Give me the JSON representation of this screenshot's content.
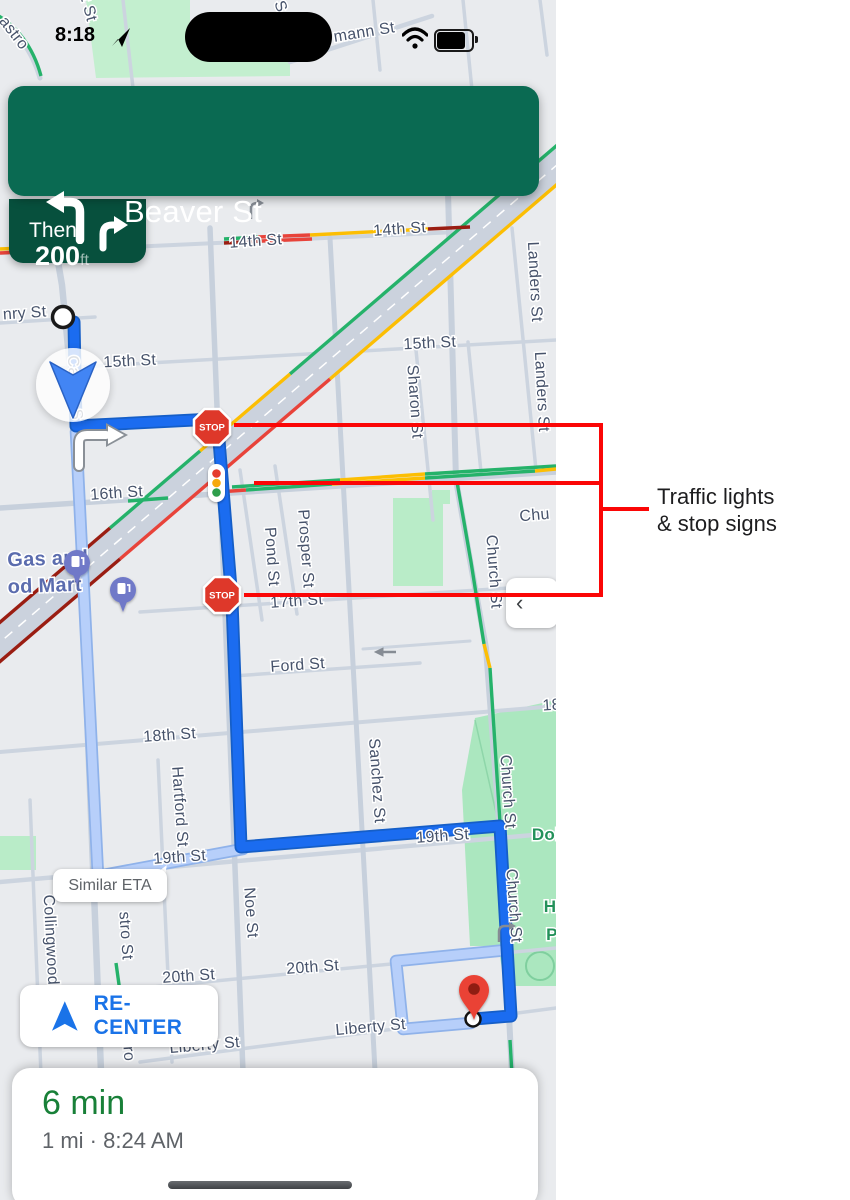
{
  "status_bar": {
    "time": "8:18"
  },
  "navigation_banner": {
    "distance": "200",
    "unit": "ft",
    "instruction": "Beaver St",
    "then_label": "Then"
  },
  "map": {
    "stop_sign_text": "STOP",
    "similar_eta_label": "Similar ETA",
    "recenter_label": "RE-CENTER",
    "side_panel_chevron": "‹",
    "labels": [
      {
        "t": "astro",
        "x": 10,
        "y": 36,
        "r": 52,
        "c": "st"
      },
      {
        "t": "t St",
        "x": 84,
        "y": 10,
        "r": 75,
        "c": "st"
      },
      {
        "t": "S",
        "x": 276,
        "y": 8,
        "r": 70,
        "c": "st"
      },
      {
        "t": "mann St",
        "x": 365,
        "y": 37,
        "r": -9,
        "c": "st"
      },
      {
        "t": "nry St",
        "x": 25,
        "y": 318,
        "r": -4,
        "c": "st"
      },
      {
        "t": "Castro S",
        "x": 70,
        "y": 388,
        "r": 86,
        "c": "st"
      },
      {
        "t": "15th St",
        "x": 130,
        "y": 366,
        "r": -3,
        "c": "st"
      },
      {
        "t": "15th St",
        "x": 430,
        "y": 348,
        "r": -3,
        "c": "st"
      },
      {
        "t": "14th St",
        "x": 256,
        "y": 246,
        "r": -4,
        "c": "st"
      },
      {
        "t": "14th St",
        "x": 400,
        "y": 234,
        "r": -4,
        "c": "st"
      },
      {
        "t": "Sharon St",
        "x": 410,
        "y": 402,
        "r": 86,
        "c": "st"
      },
      {
        "t": "Landers St",
        "x": 530,
        "y": 282,
        "r": 87,
        "c": "st"
      },
      {
        "t": "Landers St",
        "x": 537,
        "y": 392,
        "r": 87,
        "c": "st"
      },
      {
        "t": "16th St",
        "x": 117,
        "y": 498,
        "r": -4,
        "c": "st"
      },
      {
        "t": "Pond St",
        "x": 267,
        "y": 557,
        "r": 86,
        "c": "st"
      },
      {
        "t": "Prosper St",
        "x": 301,
        "y": 549,
        "r": 86,
        "c": "st"
      },
      {
        "t": "Chu",
        "x": 535,
        "y": 520,
        "r": -5,
        "c": "st"
      },
      {
        "t": "Church St",
        "x": 489,
        "y": 572,
        "r": 86,
        "c": "st"
      },
      {
        "t": "17th St",
        "x": 297,
        "y": 606,
        "r": -4,
        "c": "st"
      },
      {
        "t": "Ford St",
        "x": 298,
        "y": 670,
        "r": -4,
        "c": "st"
      },
      {
        "t": "18th St",
        "x": 170,
        "y": 740,
        "r": -4,
        "c": "st"
      },
      {
        "t": "18",
        "x": 552,
        "y": 710,
        "r": -4,
        "c": "st"
      },
      {
        "t": "Hartford St",
        "x": 175,
        "y": 807,
        "r": 86,
        "c": "st"
      },
      {
        "t": "Sanchez St",
        "x": 372,
        "y": 781,
        "r": 86,
        "c": "st"
      },
      {
        "t": "Church St",
        "x": 503,
        "y": 792,
        "r": 86,
        "c": "st"
      },
      {
        "t": "Church St",
        "x": 509,
        "y": 906,
        "r": 86,
        "c": "st"
      },
      {
        "t": "Dol",
        "x": 546,
        "y": 840,
        "r": 0,
        "c": "pg"
      },
      {
        "t": "H",
        "x": 550,
        "y": 912,
        "r": 0,
        "c": "pg"
      },
      {
        "t": "P",
        "x": 552,
        "y": 940,
        "r": 0,
        "c": "pg"
      },
      {
        "t": "19th St",
        "x": 443,
        "y": 841,
        "r": -4,
        "c": "st"
      },
      {
        "t": "19th St",
        "x": 180,
        "y": 862,
        "r": -4,
        "c": "st"
      },
      {
        "t": "Collingwood",
        "x": 46,
        "y": 940,
        "r": 87,
        "c": "st"
      },
      {
        "t": "stro St",
        "x": 121,
        "y": 936,
        "r": 86,
        "c": "st"
      },
      {
        "t": "Noe St",
        "x": 246,
        "y": 913,
        "r": 86,
        "c": "st"
      },
      {
        "t": "20th St",
        "x": 189,
        "y": 981,
        "r": -4,
        "c": "st"
      },
      {
        "t": "20th St",
        "x": 313,
        "y": 972,
        "r": -4,
        "c": "st"
      },
      {
        "t": "Liberty St",
        "x": 371,
        "y": 1032,
        "r": -5,
        "c": "st"
      },
      {
        "t": "Liberty St",
        "x": 205,
        "y": 1050,
        "r": -5,
        "c": "st"
      },
      {
        "t": "ro",
        "x": 124,
        "y": 1054,
        "r": 86,
        "c": "st"
      },
      {
        "t": "Gas and",
        "x": 48,
        "y": 565,
        "r": -2,
        "c": "pb"
      },
      {
        "t": "od Mart",
        "x": 45,
        "y": 592,
        "r": -2,
        "c": "pb"
      }
    ]
  },
  "annotation": {
    "line1": "Traffic lights",
    "line2": "& stop signs"
  },
  "bottom_sheet": {
    "eta": "6 min",
    "details": "1 mi · 8:24 AM"
  },
  "colors": {
    "banner_green": "#0a6a52",
    "banner_dark": "#07503d",
    "route_blue": "#1b6cf0",
    "route_casing": "#155ec7",
    "route_alt": "#b7cffa",
    "route_alt_casing": "#8fb2ea",
    "annotation_red": "#fb0606",
    "link_blue": "#1a73e8",
    "eta_green": "#188038",
    "traffic_green": "#25b26a",
    "traffic_yellow": "#fcbe03",
    "traffic_red": "#e8433a",
    "traffic_darkred": "#9a1d12",
    "stop_red": "#de382c",
    "pin_red": "#ea4335",
    "gas_purple": "#6f79c8",
    "park_green": "#b9ecc8"
  }
}
